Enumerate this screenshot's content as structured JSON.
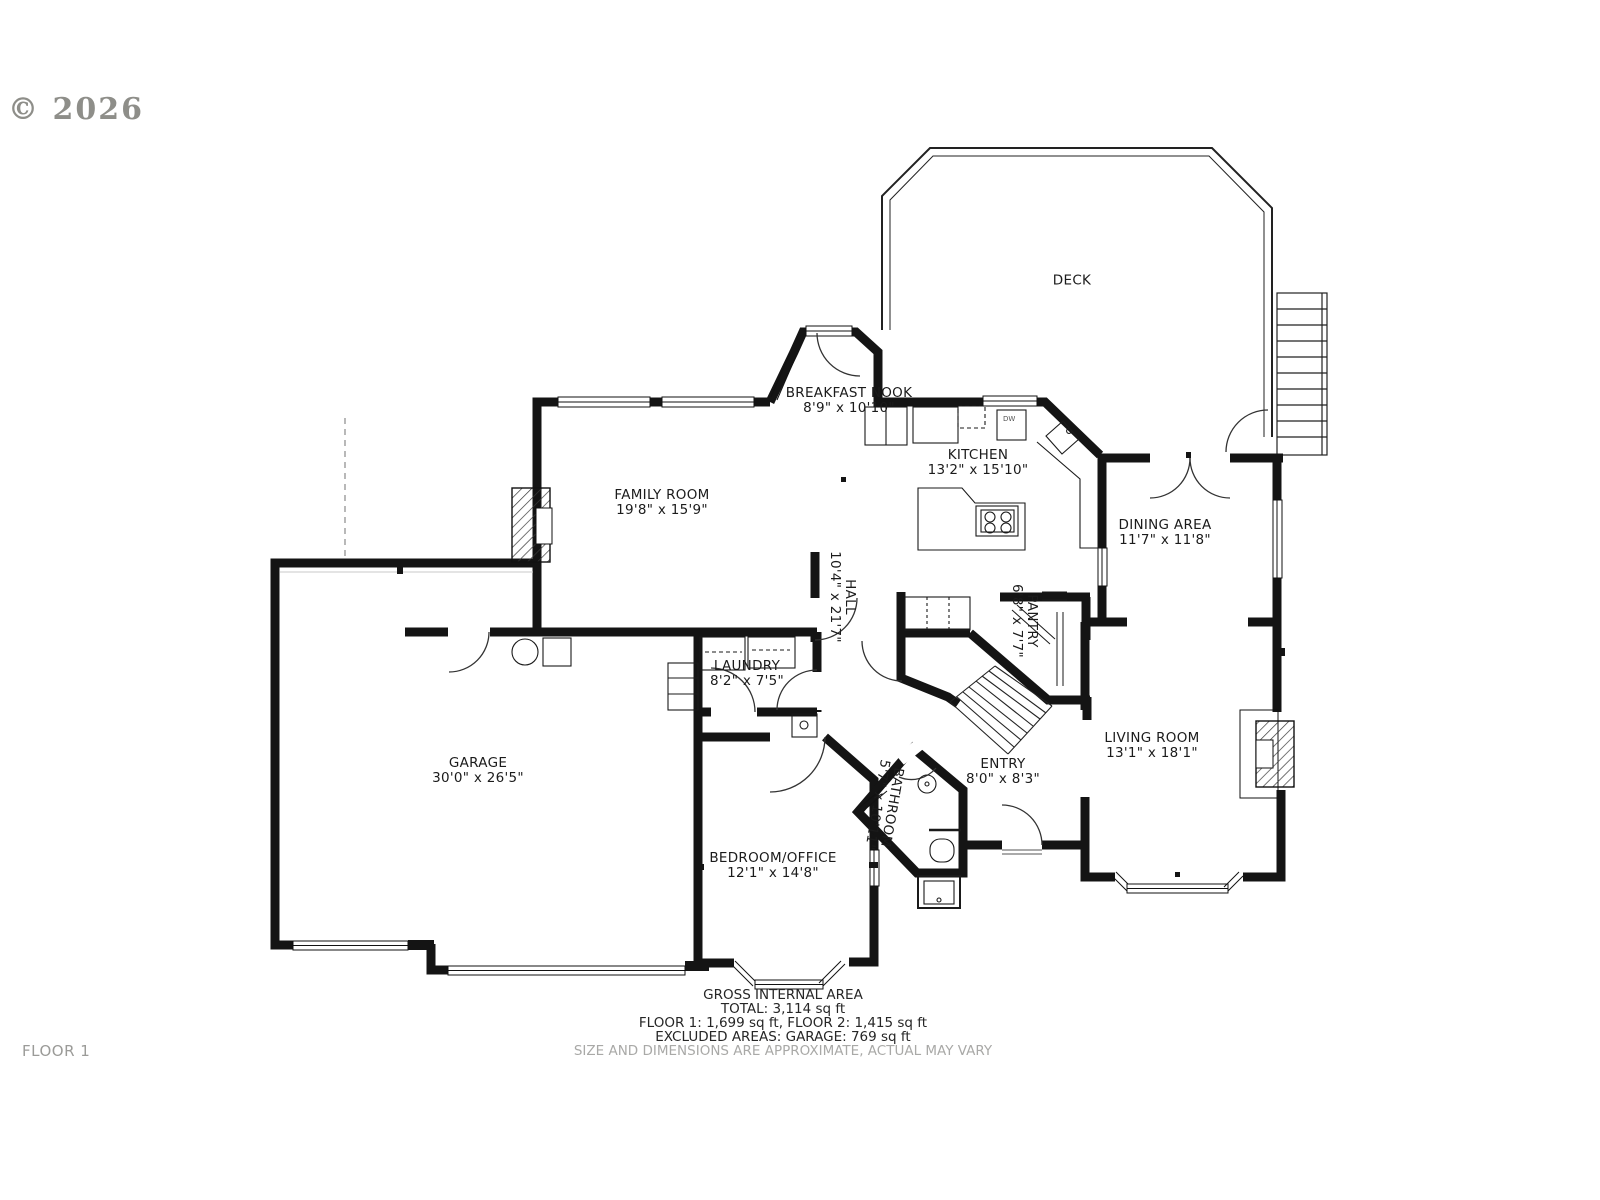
{
  "watermark": "© 2026",
  "floor_label": "FLOOR 1",
  "rooms": {
    "deck": {
      "name": "DECK",
      "dims": ""
    },
    "breakfast_nook": {
      "name": "BREAKFAST NOOK",
      "dims": "8'9\" x 10'10\""
    },
    "kitchen": {
      "name": "KITCHEN",
      "dims": "13'2\" x 15'10\""
    },
    "dining": {
      "name": "DINING AREA",
      "dims": "11'7\" x 11'8\""
    },
    "family": {
      "name": "FAMILY ROOM",
      "dims": "19'8\" x 15'9\""
    },
    "hall": {
      "name": "HALL",
      "dims": "10'4\" x 21'7\""
    },
    "pantry": {
      "name": "PANTRY",
      "dims": "6'8\" x 7'7\""
    },
    "laundry": {
      "name": "LAUNDRY",
      "dims": "8'2\" x 7'5\""
    },
    "garage": {
      "name": "GARAGE",
      "dims": "30'0\" x 26'5\""
    },
    "living": {
      "name": "LIVING ROOM",
      "dims": "13'1\" x 18'1\""
    },
    "entry": {
      "name": "ENTRY",
      "dims": "8'0\" x 8'3\""
    },
    "bathroom": {
      "name": "BATHROOM",
      "dims": "5'7\" x 10'11\""
    },
    "bedroom": {
      "name": "BEDROOM/OFFICE",
      "dims": "12'1\" x 14'8\""
    }
  },
  "appliances": {
    "dishwasher": "DW"
  },
  "footer": {
    "line1": "GROSS INTERNAL AREA",
    "line2": "TOTAL: 3,114 sq ft",
    "line3": "FLOOR 1: 1,699 sq ft, FLOOR 2: 1,415 sq ft",
    "line4": "EXCLUDED AREAS: GARAGE: 769 sq ft",
    "disclaimer": "SIZE AND DIMENSIONS ARE APPROXIMATE, ACTUAL MAY VARY"
  },
  "colors": {
    "wall": "#141414",
    "thin_line": "#1a1a1a",
    "watermark_gray": "#8e8e89",
    "footer_gray": "#a9a9a7"
  }
}
